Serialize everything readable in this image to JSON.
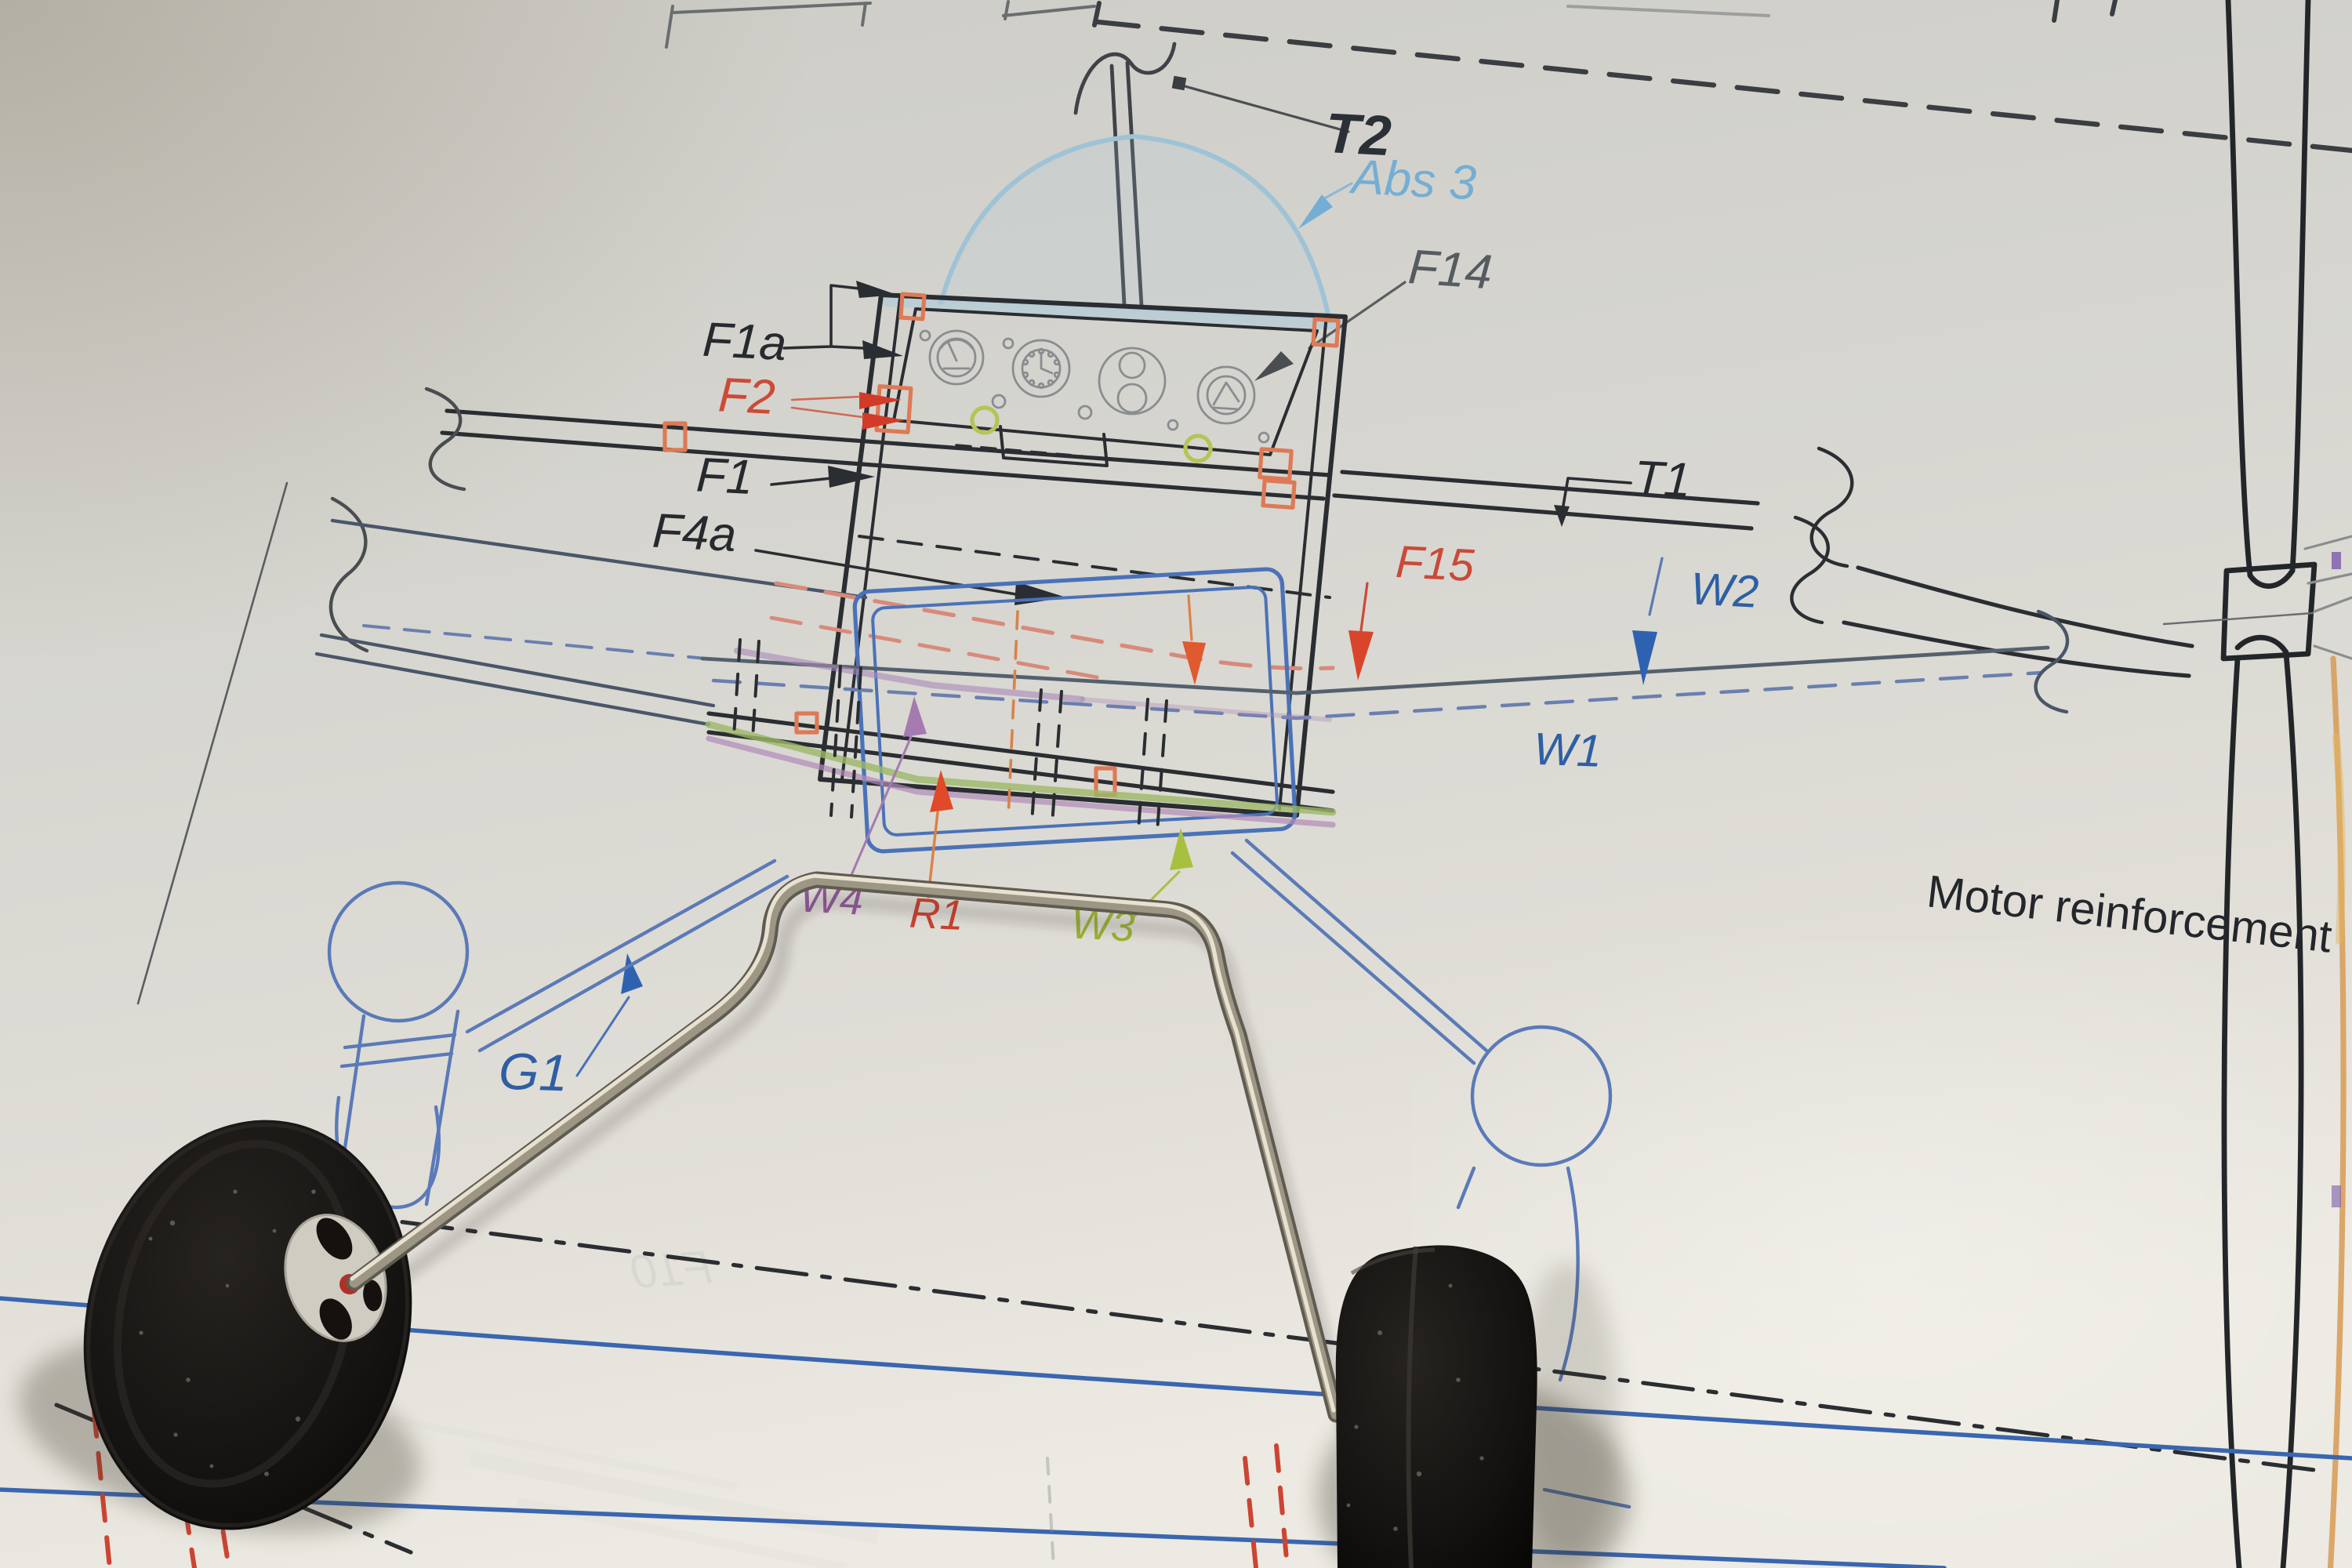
{
  "labels": {
    "t2": {
      "text": "T2",
      "color": "#2b2f36"
    },
    "abs3": {
      "text": "Abs 3",
      "color": "#74aed4"
    },
    "f14": {
      "text": "F14",
      "color": "#565b60"
    },
    "f1a": {
      "text": "F1a",
      "color": "#26292e"
    },
    "f2": {
      "text": "F2",
      "color": "#cc4a36"
    },
    "f1": {
      "text": "F1",
      "color": "#26292e"
    },
    "f4a": {
      "text": "F4a",
      "color": "#26292e"
    },
    "t1": {
      "text": "T1",
      "color": "#26292e"
    },
    "f15": {
      "text": "F15",
      "color": "#c94a38"
    },
    "w2": {
      "text": "W2",
      "color": "#2e5fa3"
    },
    "w1": {
      "text": "W1",
      "color": "#2e5fa3"
    },
    "w4": {
      "text": "W4",
      "color": "#8f5a9c"
    },
    "r1": {
      "text": "R1",
      "color": "#c8412f"
    },
    "w3": {
      "text": "W3",
      "color": "#9ab233"
    },
    "g1": {
      "text": "G1",
      "color": "#2e5fa3"
    },
    "motor_reinforcement": {
      "text": "Motor reinforcement",
      "color": "#23262b"
    },
    "bleed_through": {
      "text": "F10",
      "color": "#6a7684"
    }
  },
  "colors": {
    "paper": "#d8d7d1",
    "plan_black": "#2a2d31",
    "plan_gray": "#8a8d90",
    "plan_blue": "#4a72b8",
    "plan_light_blue": "#a8cada",
    "plan_orange": "#dd7a55",
    "plan_red": "#d23b28",
    "plan_green": "#9cb868",
    "plan_purple": "#a888b8",
    "wire_metal": "#9d9684",
    "tire_black": "#0d0b0a",
    "hub_white": "#cfccc2"
  }
}
